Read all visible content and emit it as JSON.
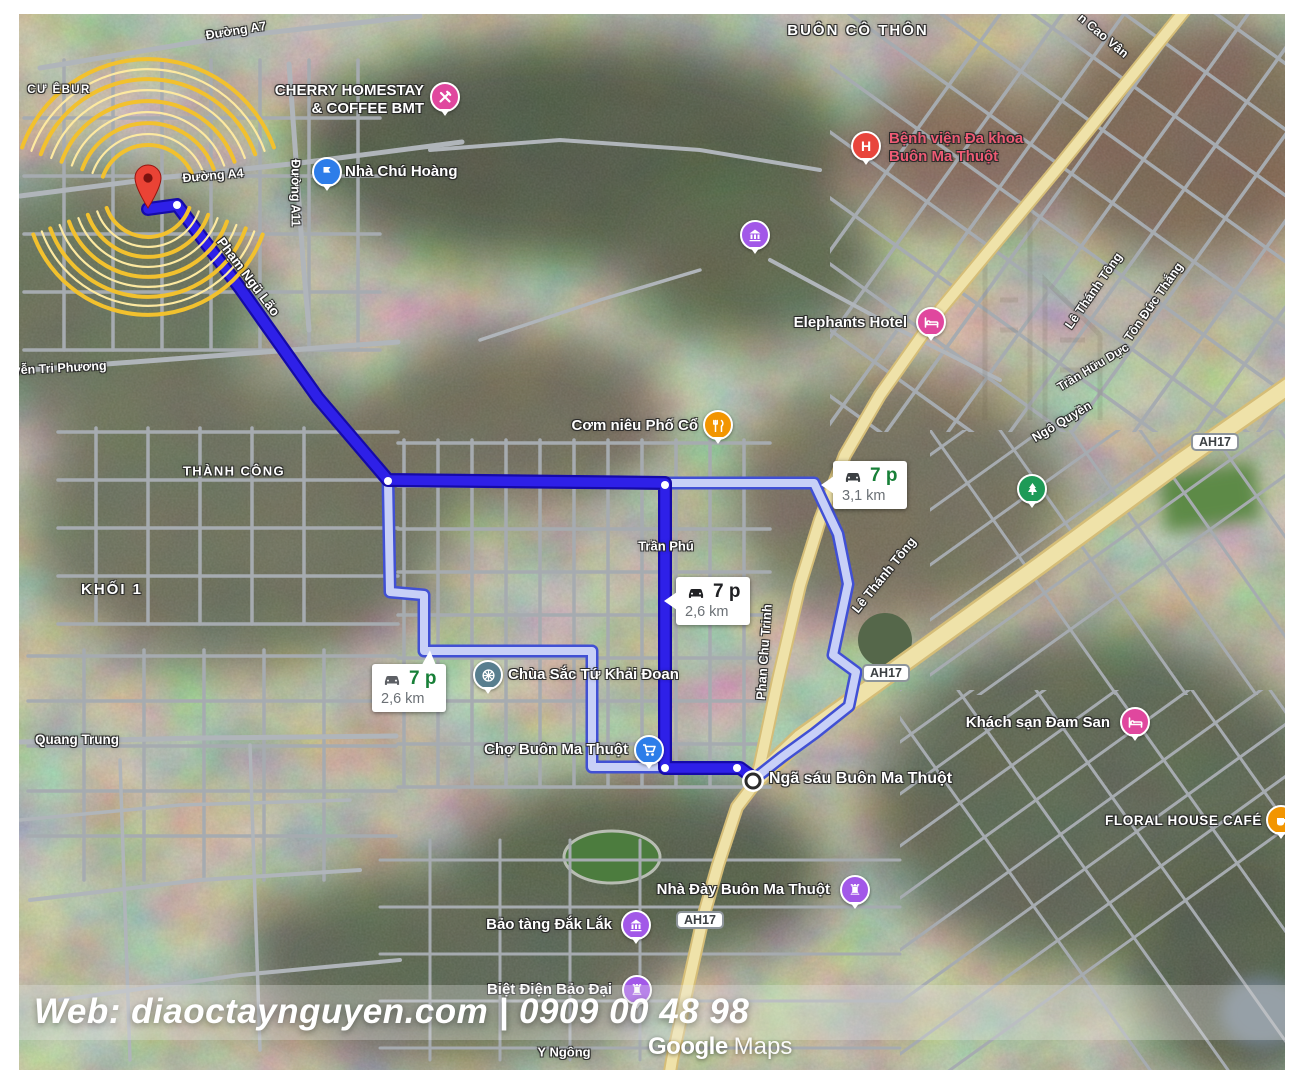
{
  "colors": {
    "route_primary": "#2e20e8",
    "route_primary_casing": "#150aa8",
    "route_alt_fill": "#c8d0f7",
    "route_alt_casing": "#4150d4",
    "highway_fill": "#efe2a9",
    "highway_casing": "#d5bd77",
    "road_gray": "#a6abb0",
    "pin_red": "#ea4335",
    "poi_pink": "#e0479e",
    "poi_blue": "#2d7de9",
    "poi_purple": "#a258e8",
    "poi_orange": "#f29500",
    "poi_slate": "#587e8e",
    "poi_green": "#1e9a57",
    "poi_red": "#e8453c",
    "poi_hospital_text": "#ee5b74",
    "time_green": "#188038",
    "distance_gray": "#6b7075",
    "arc_yellow": "#f2c12e",
    "arc_pale": "#fde9a0"
  },
  "areas": {
    "cu_ebur": "CƯ ÊBUR",
    "buon_co_thon": "BUÔN CÔ THÔN",
    "thanh_cong": "THÀNH CÔNG",
    "khoi_1": "KHỐI 1"
  },
  "roads": {
    "duong_a7": "Đường A7",
    "duong_a4": "Đường A4",
    "duong_a11": "Đường A11",
    "pham_ngu_lao": "Phạm Ngũ Lão",
    "nguyen_tri_phuong": "Nguyễn Tri Phương",
    "quang_trung": "Quang Trung",
    "tran_phu": "Trần Phú",
    "phan_chu_trinh": "Phan Chu Trinh",
    "le_thanh_tong_mid": "Lê Thánh Tông",
    "le_thanh_tong_top": "Lê Thánh Tông",
    "ton_duc_thang": "Tôn Đức Thắng",
    "tran_huu_duc": "Trần Hữu Dực",
    "ngo_quyen": "Ngô Quyền",
    "cao_van": "n Cao Vân",
    "y_ngong": "Y Ngông"
  },
  "badges": {
    "ah17": "AH17"
  },
  "pois": {
    "cherry": {
      "label": "CHERRY HOMESTAY\n& COFFEE BMT"
    },
    "parking": {
      "label": "Nhà Chú Hoàng"
    },
    "hospital": {
      "label": "Bệnh viện Đa khoa\nBuôn Ma Thuột"
    },
    "elephants": {
      "label": "Elephants Hotel"
    },
    "comnieu": {
      "label": "Cơm niêu Phố Cổ"
    },
    "chua": {
      "label": "Chùa Sắc Tứ Khải Đoan"
    },
    "cho": {
      "label": "Chợ Buôn Ma Thuột"
    },
    "ngasau": {
      "label": "Ngã sáu Buôn Ma Thuột"
    },
    "damsan": {
      "label": "Khách sạn Đam San"
    },
    "floral": {
      "label": "FLORAL HOUSE CAFÉ"
    },
    "nhaday": {
      "label": "Nhà Đày Buôn Ma Thuột"
    },
    "baotang": {
      "label": "Bảo tàng Đắk Lắk"
    },
    "bietdien": {
      "label": "Biệt Điện Bảo Đại"
    }
  },
  "route_bubbles": {
    "left": {
      "time": "7 p",
      "distance": "2,6 km"
    },
    "center": {
      "time": "7 p",
      "distance": "2,6 km"
    },
    "right": {
      "time": "7 p",
      "distance": "3,1 km"
    }
  },
  "watermark": {
    "text": "Web: diaoctaynguyen.com | 0909 00 48 98"
  },
  "branding": {
    "google": "Google",
    "maps": "Maps"
  }
}
